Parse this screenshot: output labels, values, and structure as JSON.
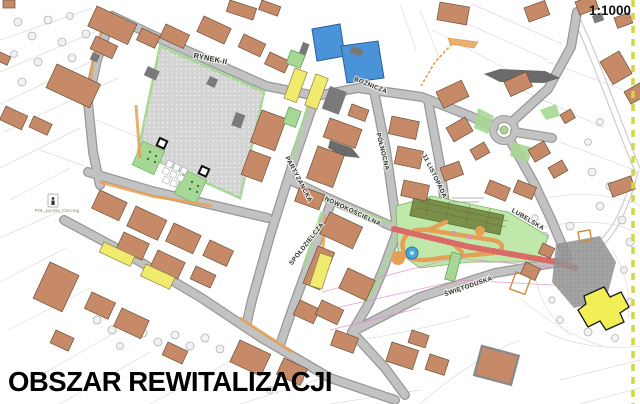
{
  "title": "OBSZAR REWITALIZACJI",
  "scale_label": "1:1000",
  "map": {
    "square_label": "RYNEK II",
    "streets": [
      {
        "id": "partyzancka",
        "name": "PARTYZANCKA"
      },
      {
        "id": "boznicza",
        "name": "BOŻNICZA"
      },
      {
        "id": "polnocna",
        "name": "PÓŁNOCNA"
      },
      {
        "id": "11-listopada",
        "name": "11 LISTOPADA"
      },
      {
        "id": "nowokoscielna",
        "name": "NOWOKOŚCIELNA"
      },
      {
        "id": "spoldzielcza",
        "name": "SPÓŁDZIELCZA"
      },
      {
        "id": "lubelska",
        "name": "LUBELSKA"
      },
      {
        "id": "swietoduska",
        "name": "ŚWIĘTODUSKA"
      }
    ],
    "broken_image_caption": "POL_Łęczna_COA.svg"
  },
  "palette": {
    "building": "#c78a68",
    "building_outline": "#6b5138",
    "building_dark": "#7a7a7a",
    "road": "#c2c2c2",
    "road_edge": "#989898",
    "square": "#d4d4d4",
    "green": "#a6d795",
    "park": "#bfe8aa",
    "park_garden": "#7c8f4a",
    "path_orange": "#e6a055",
    "water": "#4b93d8",
    "yellow": "#f0ea6e",
    "pink_road": "#f3b8b4",
    "pink_road_hatch": "#d96a66",
    "church": "#f2ee55",
    "boundary": "#d6d63e",
    "magenta": "#e08ad0",
    "label": "#2e2e2e",
    "title_color": "#000000"
  }
}
